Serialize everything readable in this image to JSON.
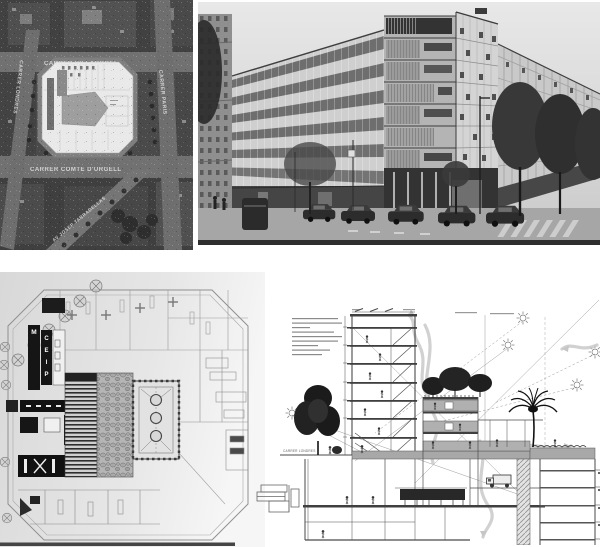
{
  "page": {
    "background": "#ffffff"
  },
  "aerial_map": {
    "labels": {
      "top": "CARRER VILLARROEL",
      "bottom": "CARRER COMTE D'URGELL",
      "right": "CARRER PARIS",
      "left": "CARRER LONDRES",
      "diagonal": "AV JOSEP TARRADELLAS"
    }
  },
  "floor_plan": {
    "band1_letters": [
      "M"
    ],
    "band2_letters": [
      "C",
      "E",
      "I",
      "P"
    ]
  },
  "section_drawing": {
    "street_label": "CARRER LONDRES"
  },
  "colors": {
    "page_bg": "#ffffff",
    "aerial_ground": "#4a4a4a",
    "aerial_street": "#717171",
    "plan_overlay": "#e9e9e9",
    "photo_sky": "#e2e2e2",
    "photo_dark": "#2f2f2f",
    "scan_bg": "#dedede",
    "drawing_line": "#4a4a4a",
    "poche_gray": "#a8a8a8",
    "flow_arrow": "#c6c6c6"
  }
}
